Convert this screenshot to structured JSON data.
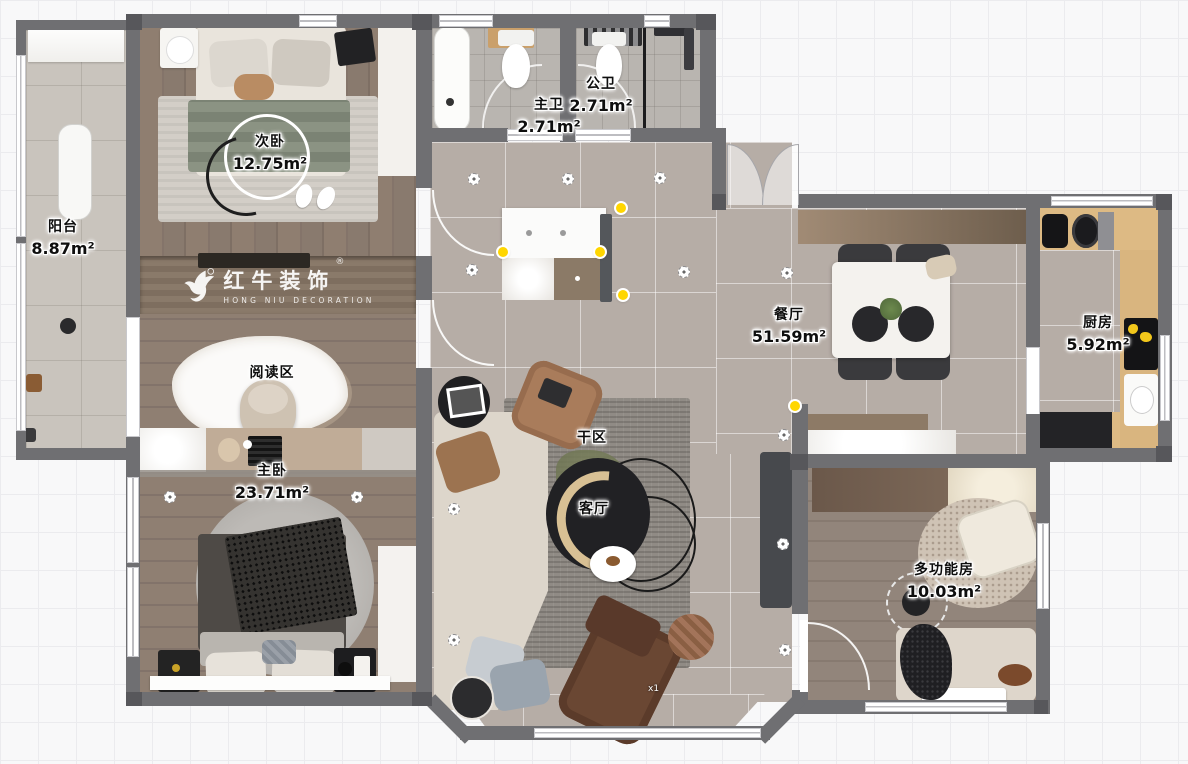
{
  "app": {
    "type": "floorplan-viewer"
  },
  "logo": {
    "brand": "红牛装饰",
    "subtitle": "HONG NIU DECORATION",
    "registered": "®"
  },
  "rooms": {
    "balcony": {
      "label": "阳台",
      "area": "8.87m²"
    },
    "second_bedroom": {
      "label": "次卧",
      "area": "12.75m²"
    },
    "master_bathroom": {
      "label": "主卫",
      "area": "2.71m²"
    },
    "guest_bathroom": {
      "label": "公卫",
      "area": "2.71m²"
    },
    "dining_room": {
      "label": "餐厅",
      "area": "51.59m²"
    },
    "kitchen": {
      "label": "厨房",
      "area": "5.92m²"
    },
    "reading_area": {
      "label": "阅读区"
    },
    "master_bedroom": {
      "label": "主卧",
      "area": "23.71m²"
    },
    "dry_area": {
      "label": "干区"
    },
    "living_room": {
      "label": "客厅"
    },
    "multipurpose_room": {
      "label": "多功能房",
      "area": "10.03m²"
    }
  },
  "badges": {
    "recliner_qty": "x1"
  },
  "colors": {
    "selection_handle": "#ffd600",
    "wall": "#6f6f72",
    "label_text": "#0e0e0e",
    "label_halo": "#ffffff",
    "wood_floor": "#8a7a6d",
    "tile_floor": "#b6ada6"
  }
}
